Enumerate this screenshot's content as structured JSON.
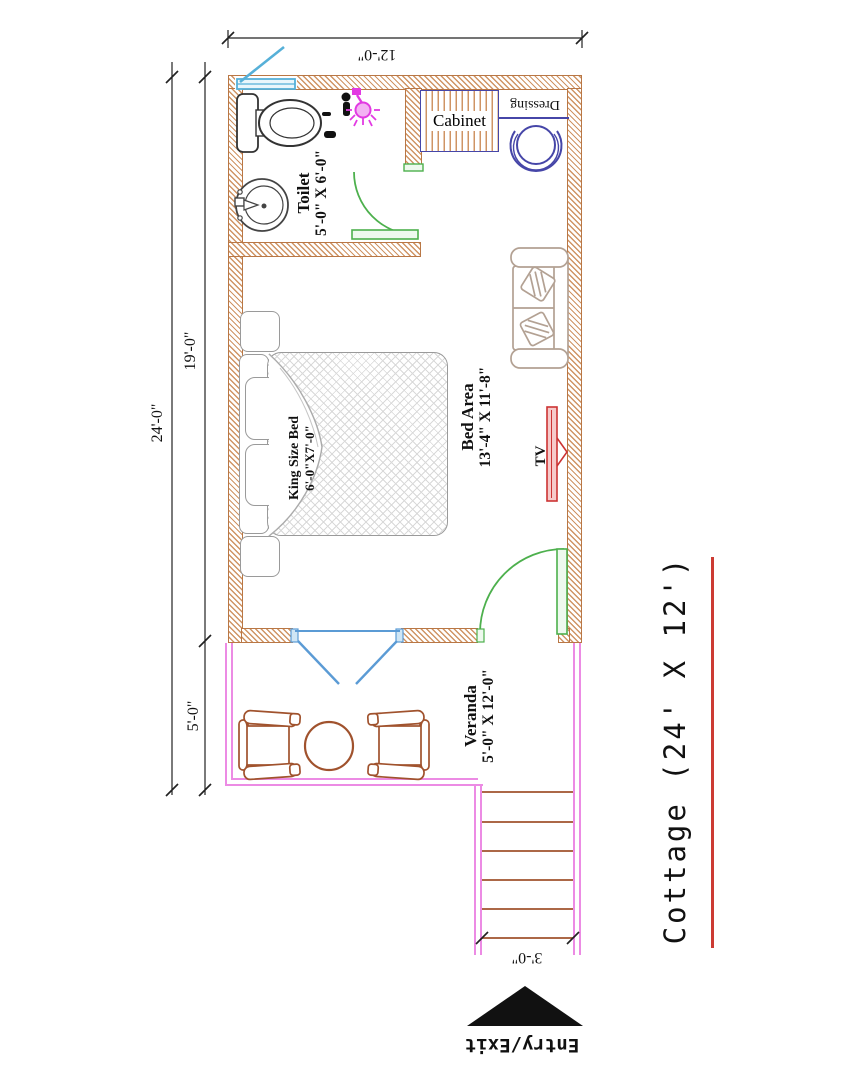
{
  "title": {
    "text": "Cottage (24' X 12')"
  },
  "entry": {
    "label": "Entry/Exit"
  },
  "rooms": {
    "toilet": {
      "name": "Toilet",
      "dims": "5'-0\" X 6'-0\""
    },
    "bed_area": {
      "name": "Bed Area",
      "dims": "13'-4\" X 11'-8\""
    },
    "veranda": {
      "name": "Veranda",
      "dims": "5'-0\" X 12'-0\""
    }
  },
  "furniture": {
    "cabinet_label": "Cabinet",
    "dressing_label": "Dressing",
    "tv_label": "TV",
    "king_bed": {
      "name": "King Size Bed",
      "dims": "6'-0\"X7'-0\""
    }
  },
  "dims": {
    "width_top": "12'-0\"",
    "overall_left": "24'-0\"",
    "room_left": "19'-0\"",
    "veranda_left": "5'-0\"",
    "stairs_bottom": "3'-0\""
  },
  "colors": {
    "wall_hatch": "#cf9464",
    "wall_border": "#b97745",
    "door_green": "#4db04d",
    "window_cyan": "#56b0d8",
    "casement_blue": "#5b9bd5",
    "veranda_magenta": "#ec8be4",
    "stairs_step_brown": "#a0522d",
    "chair_brown": "#a0522d",
    "tv_red": "#cc3333",
    "stool_indigo": "#4646a8",
    "title_underline_red": "#cc3b33",
    "sofa_tan": "#b3a193",
    "text_black": "#111111"
  }
}
